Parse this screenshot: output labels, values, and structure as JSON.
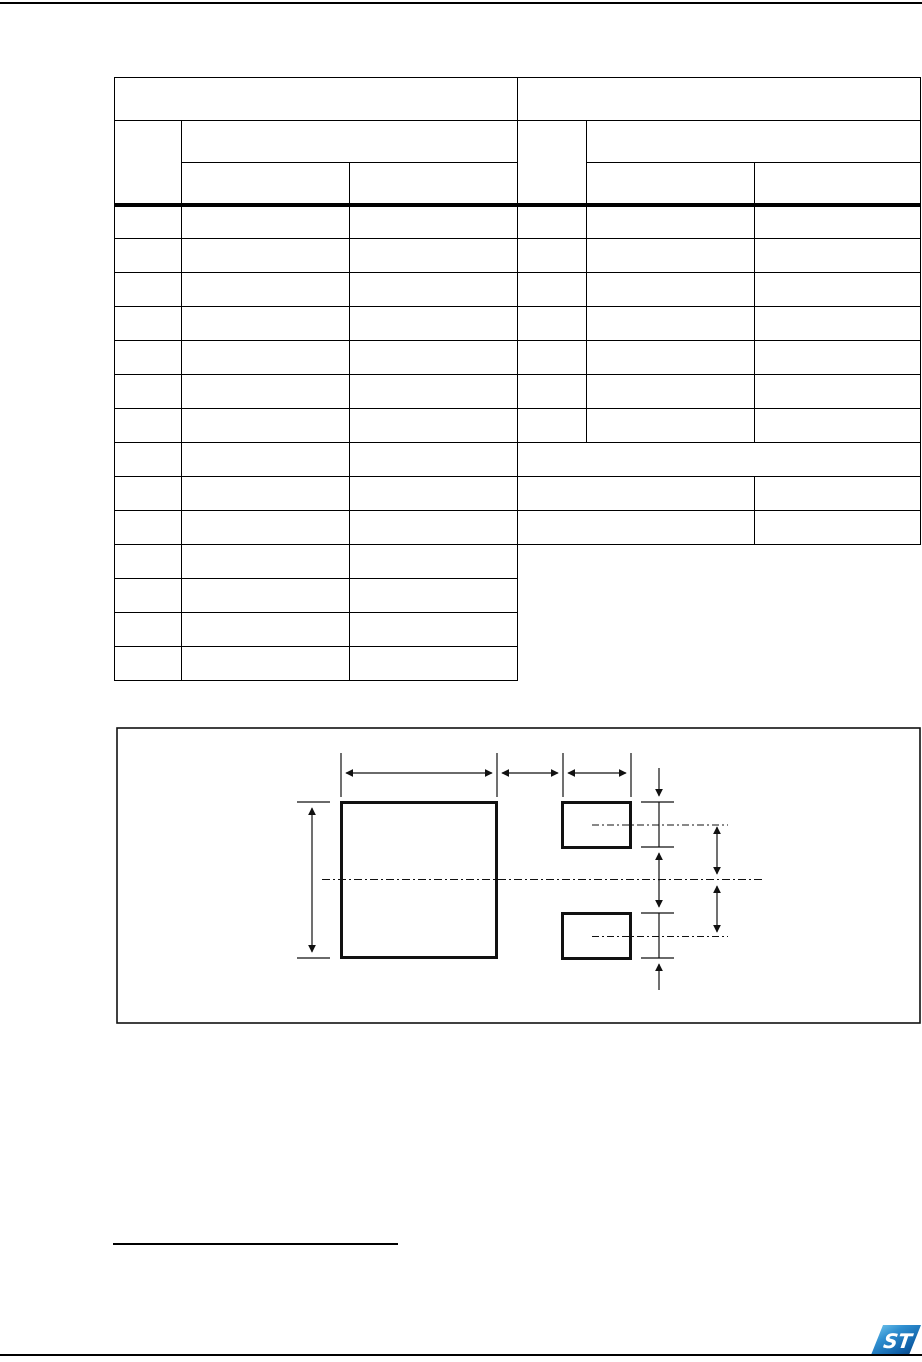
{
  "page": {
    "width_px": 922,
    "height_px": 1362,
    "background_color": "#ffffff",
    "line_color": "#000000"
  },
  "table": {
    "column_count": 6,
    "header_rows": 3,
    "body_rows": 14,
    "all_cells_blank": true,
    "thick_separator_below_header": true
  },
  "figure": {
    "kind": "package-footprint-diagram",
    "pads": [
      "large-pad",
      "upper-small-pad",
      "lower-small-pad"
    ],
    "dimension_arrow_count": 9,
    "centerline_style": "dash-dot",
    "all_labels_blank": true
  },
  "footnote": {
    "rule_present": true,
    "text_blank": true
  },
  "footer": {
    "logo": "st-logo",
    "logo_monogram": "ST",
    "logo_gradient": [
      "#7fd0f2",
      "#2f8fd0",
      "#0e5ea6",
      "#093d72"
    ]
  }
}
